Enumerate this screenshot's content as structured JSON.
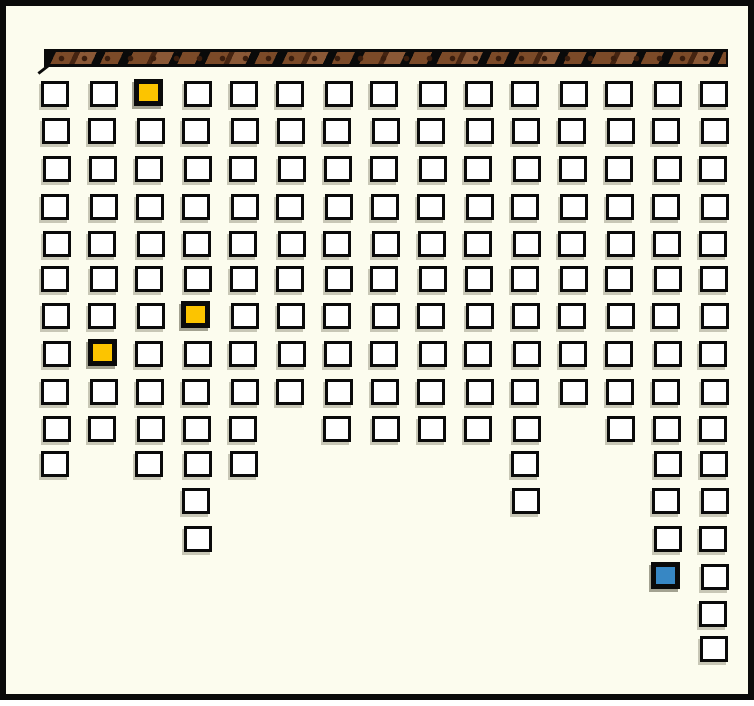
{
  "canvas": {
    "background": "#fcfcee",
    "border_color": "#0a0a0a"
  },
  "rod": {
    "description": "textured horizontal hanging rod",
    "colors": {
      "ink": "#0a0a0a",
      "brown1": "#8a5836",
      "brown2": "#7b4a28",
      "brown3": "#452411",
      "spot": "#3a1d0d"
    }
  },
  "chart_data": {
    "type": "bar",
    "subtype": "unit-square icon columns hanging downward from a rod",
    "orientation": "vertical-down",
    "title": "",
    "xlabel": "",
    "ylabel": "",
    "categories": [
      1,
      2,
      3,
      4,
      5,
      6,
      7,
      8,
      9,
      10,
      11,
      12,
      13,
      14,
      15
    ],
    "values": [
      11,
      10,
      11,
      13,
      11,
      9,
      10,
      10,
      10,
      10,
      12,
      9,
      10,
      14,
      16
    ],
    "max_rows": 16,
    "total_squares": 166,
    "grid_on": false,
    "legend": [],
    "square_fill_default": "#ffffff",
    "square_border": "#0a0a0a",
    "highlight_colors": {
      "yellow": "#fcc400",
      "blue": "#3787c4"
    },
    "highlighted_cells": [
      {
        "column": 3,
        "row": 1,
        "color": "#fcc400"
      },
      {
        "column": 4,
        "row": 7,
        "color": "#fcc400"
      },
      {
        "column": 2,
        "row": 8,
        "color": "#fcc400"
      },
      {
        "column": 14,
        "row": 14,
        "color": "#3787c4"
      }
    ]
  }
}
